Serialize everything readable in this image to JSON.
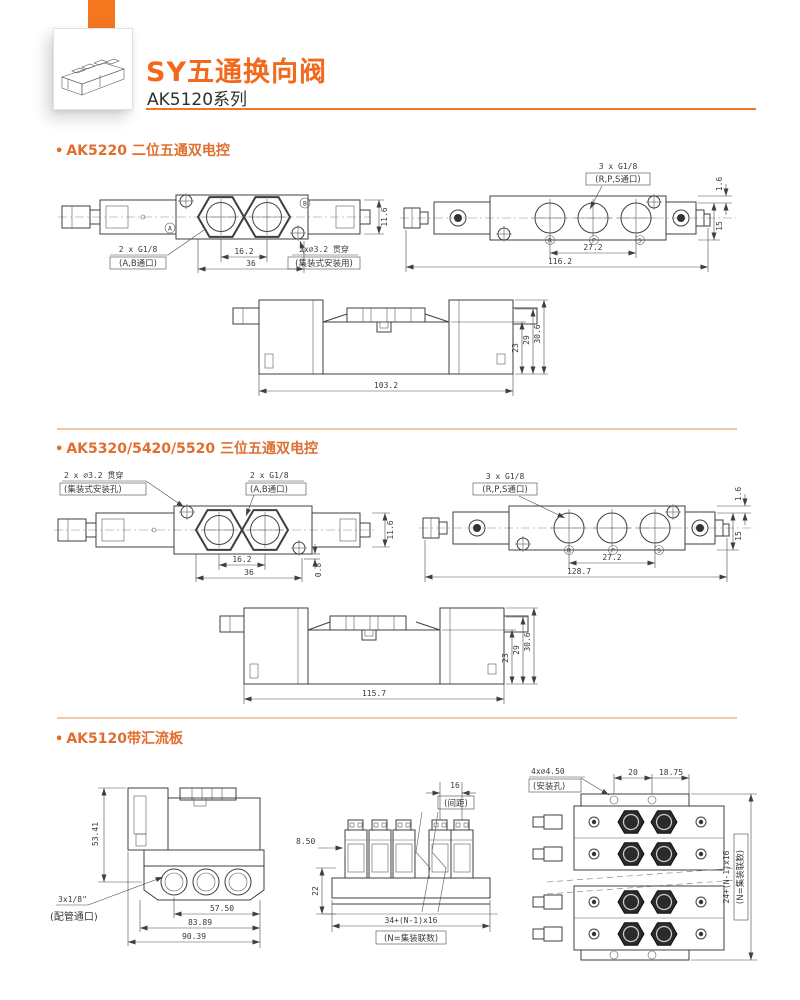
{
  "header": {
    "title": "SY五通换向阀",
    "subtitle": "AK5120系列"
  },
  "ui": {
    "bullet": "•"
  },
  "colors": {
    "accent": "#F4771F",
    "title": "#F2681C",
    "section_title": "#E06E2E",
    "divider": "#F2C9A8"
  },
  "s1": {
    "title": "AK5220 二位五通双电控",
    "top": {
      "label_g18_1": "2 x G1/8",
      "label_g18_2": "(A,B通口)",
      "dim_16_2": "16.2",
      "dim_36": "36",
      "label_32_1": "2x∅3.2 贯穿",
      "label_32_2": "(集装式安装用)",
      "dim_11_6": "11.6",
      "port_a": "A",
      "port_b": "B"
    },
    "bottom": {
      "label_1": "3 x G1/8",
      "label_2": "(R,P,S通口)",
      "dim_27_2": "27.2",
      "dim_116_2": "116.2",
      "dim_1_6": "1.6",
      "dim_15": "15",
      "port_r": "R",
      "port_p": "P",
      "port_s": "S"
    },
    "side": {
      "dim_103_2": "103.2",
      "dim_23": "23",
      "dim_29": "29",
      "dim_30_6": "30.6"
    }
  },
  "s2": {
    "title": "AK5320/5420/5520 三位五通双电控",
    "top": {
      "label_32_1": "2 x ∅3.2 贯穿",
      "label_32_2": "(集装式安装孔)",
      "label_g18_1": "2 x G1/8",
      "label_g18_2": "(A,B通口)",
      "dim_16_2": "16.2",
      "dim_36": "36",
      "dim_0_8": "0.8",
      "dim_11_6": "11.6"
    },
    "bottom": {
      "label_1": "3 x G1/8",
      "label_2": "(R,P,S通口)",
      "dim_27_2": "27.2",
      "dim_128_7": "128.7",
      "dim_1_6": "1.6",
      "dim_15": "15",
      "port_r": "R",
      "port_p": "P",
      "port_s": "S"
    },
    "side": {
      "dim_115_7": "115.7",
      "dim_23": "23",
      "dim_29": "29",
      "dim_30_6": "30.6"
    }
  },
  "s3": {
    "title": "AK5120带汇流板",
    "left": {
      "dim_53_41": "53.41",
      "label_1": "3x1/8\"",
      "label_2": "(配管通口)",
      "dim_57_50": "57.50",
      "dim_83_89": "83.89",
      "dim_90_39": "90.39"
    },
    "mid": {
      "dim_16": "16",
      "note_pitch": "(间距)",
      "dim_8_50": "8.50",
      "dim_22": "22",
      "formula": "34+(N-1)x16",
      "formula_note": "(N=集装联数)"
    },
    "right": {
      "label_1": "4x∅4.50",
      "label_2": "(安装孔)",
      "dim_20": "20",
      "dim_18_75": "18.75",
      "formula": "24+(N-1)x16",
      "formula_note": "(N=集装联数)"
    }
  }
}
